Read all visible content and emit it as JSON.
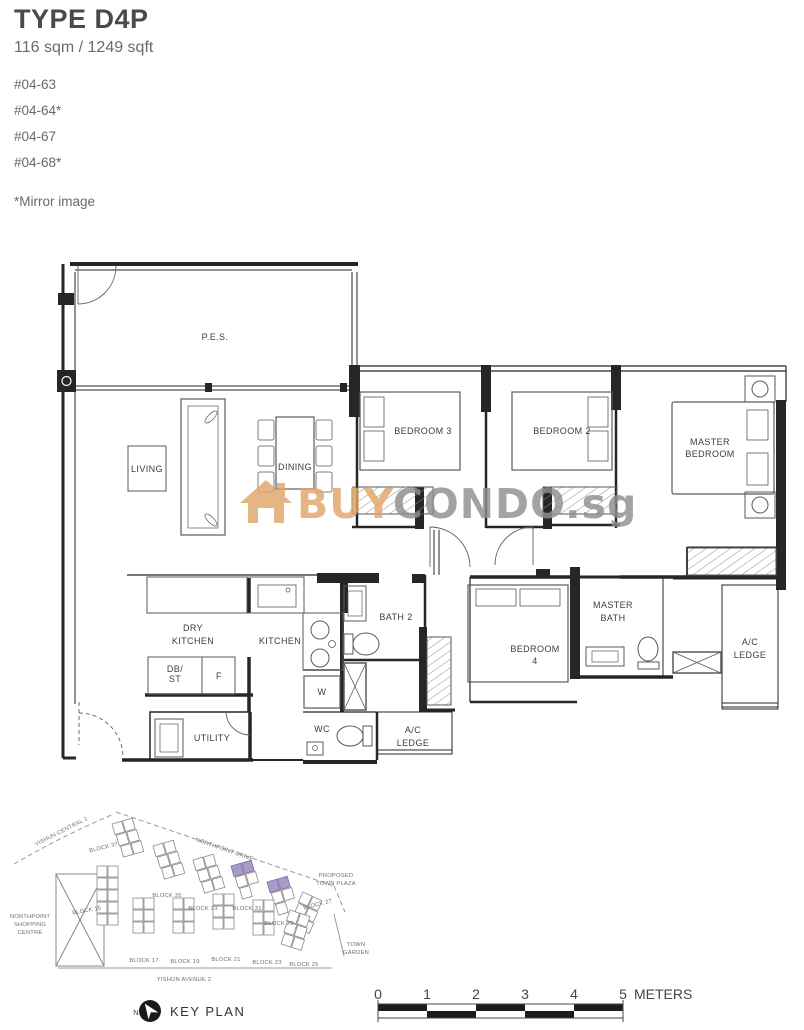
{
  "header": {
    "type_title": "TYPE D4P",
    "area": "116 sqm / 1249 sqft",
    "units": [
      "#04-63",
      "#04-64*",
      "#04-67",
      "#04-68*"
    ],
    "mirror_note": "*Mirror image"
  },
  "watermark": {
    "prefix": "BUY",
    "brand": "CONDO",
    "tld": ".sg",
    "icon": "house-icon",
    "orange": "#e0a76a",
    "gray": "#8f8f8f"
  },
  "floorplan": {
    "rooms": {
      "pes": "P.E.S.",
      "living": "LIVING",
      "dining": "DINING",
      "bedroom3": "BEDROOM 3",
      "bedroom2": "BEDROOM 2",
      "master_bedroom": [
        "MASTER",
        "BEDROOM"
      ],
      "dry_kitchen": [
        "DRY",
        "KITCHEN"
      ],
      "kitchen": "KITCHEN",
      "db_st": [
        "DB/",
        "ST"
      ],
      "fridge": "F",
      "utility": "UTILITY",
      "washer": "W",
      "wc": "WC",
      "bath2": "BATH 2",
      "bedroom4": [
        "BEDROOM",
        "4"
      ],
      "ac_ledge_1": [
        "A/C",
        "LEDGE"
      ],
      "master_bath": [
        "MASTER",
        "BATH"
      ],
      "ac_ledge_2": [
        "A/C",
        "LEDGE"
      ]
    }
  },
  "keyplan": {
    "title": "KEY PLAN",
    "north": "N",
    "roads": {
      "yishun_central_1": "YISHUN CENTRAL 1",
      "northpoint_drive": "NORTHPOINT DRIVE",
      "yishun_avenue_2": "YISHUN AVENUE 2"
    },
    "places": {
      "shopping_centre": [
        "NORTHPOINT",
        "SHOPPING",
        "CENTRE"
      ],
      "town_plaza": [
        "PROPOSED",
        "TOWN PLAZA"
      ],
      "town_garden": [
        "TOWN",
        "GARDEN"
      ]
    },
    "blocks": {
      "b37": "BLOCK 37",
      "b35": "BLOCK 35",
      "b33": "BLOCK 33",
      "b31": "BLOCK 31",
      "b29": "BLOCK 29",
      "b27": "BLOCK 27",
      "b15": "BLOCK 15",
      "b17": "BLOCK 17",
      "b19": "BLOCK 19",
      "b21": "BLOCK 21",
      "b23": "BLOCK 23",
      "b25": "BLOCK 25"
    },
    "highlighted": [
      "BLOCK 31",
      "BLOCK 29"
    ],
    "highlight_color": "#a89bc7"
  },
  "scalebar": {
    "ticks": [
      "0",
      "1",
      "2",
      "3",
      "4",
      "5"
    ],
    "unit": "METERS"
  },
  "colors": {
    "wall": "#262626",
    "thin_line": "#5a5a5a",
    "watermark_orange": "#e0a76a",
    "watermark_gray": "#8f8f8f",
    "highlight_block": "#a89bc7"
  }
}
